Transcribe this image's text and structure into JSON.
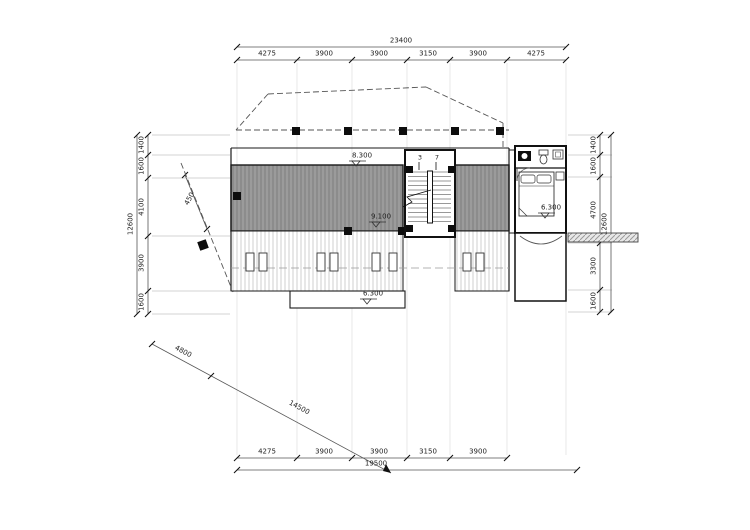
{
  "drawing": {
    "title": "roof-plan",
    "top_dim": {
      "total": "23400",
      "segments": [
        "4275",
        "3900",
        "3900",
        "3150",
        "3900",
        "4275"
      ]
    },
    "bottom_dim": {
      "total": "19500",
      "segments": [
        "4275",
        "3900",
        "3900",
        "3150",
        "3900"
      ]
    },
    "left_dim": {
      "total": "12600",
      "segments": [
        "1400",
        "1600",
        "4100",
        "3900",
        "1600"
      ]
    },
    "right_dim": {
      "total": "12600",
      "segments": [
        "1400",
        "1600",
        "4700",
        "3300",
        "1600"
      ]
    },
    "diagonal_dim": {
      "seg1": "4800",
      "seg2": "14500"
    },
    "offset_dim": "450",
    "levels": {
      "roof_upper": "8.300",
      "roof_mid": "9.100",
      "canopy": "6.300",
      "room": "6.300"
    },
    "stair": {
      "left_count": "3",
      "right_count": "7"
    },
    "colors": {
      "line": "#1a1a1a",
      "dark_roof": "#9b9b9b",
      "hatch_line": "#c9c9c9"
    }
  }
}
